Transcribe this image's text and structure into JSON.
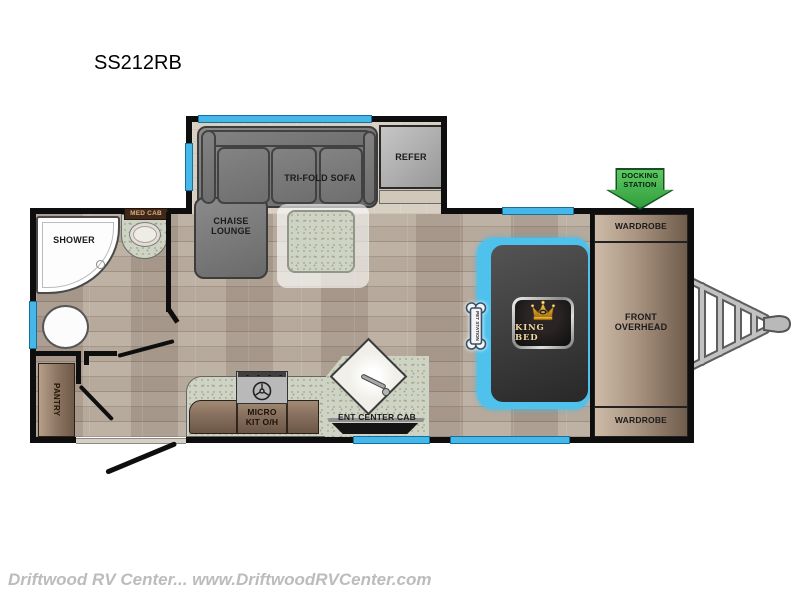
{
  "title": "SS212RB",
  "watermark": "Driftwood RV Center... www.DriftwoodRVCenter.com",
  "colors": {
    "window_cyan": "#45b7e9",
    "docking_green": "#3fae49",
    "crown_gold": "#e9b83c",
    "wall_black": "#0e0e0e",
    "cabinet_brown": "#8a7260"
  },
  "labels": {
    "shower": "SHOWER",
    "med_cab": "MED CAB",
    "chaise": "CHAISE\nLOUNGE",
    "sofa": "TRI-FOLD SOFA",
    "refer": "REFER",
    "pantry": "PANTRY",
    "micro": "MICRO\nKIT O/H",
    "ent_center": "ENT CENTER CAB",
    "king_bed": "KING BED",
    "pet_station": "PET STATION",
    "front_overhead": "FRONT\nOVERHEAD",
    "wardrobe_top": "WARDROBE",
    "wardrobe_bottom": "WARDROBE",
    "docking_station": "DOCKING\nSTATION"
  }
}
